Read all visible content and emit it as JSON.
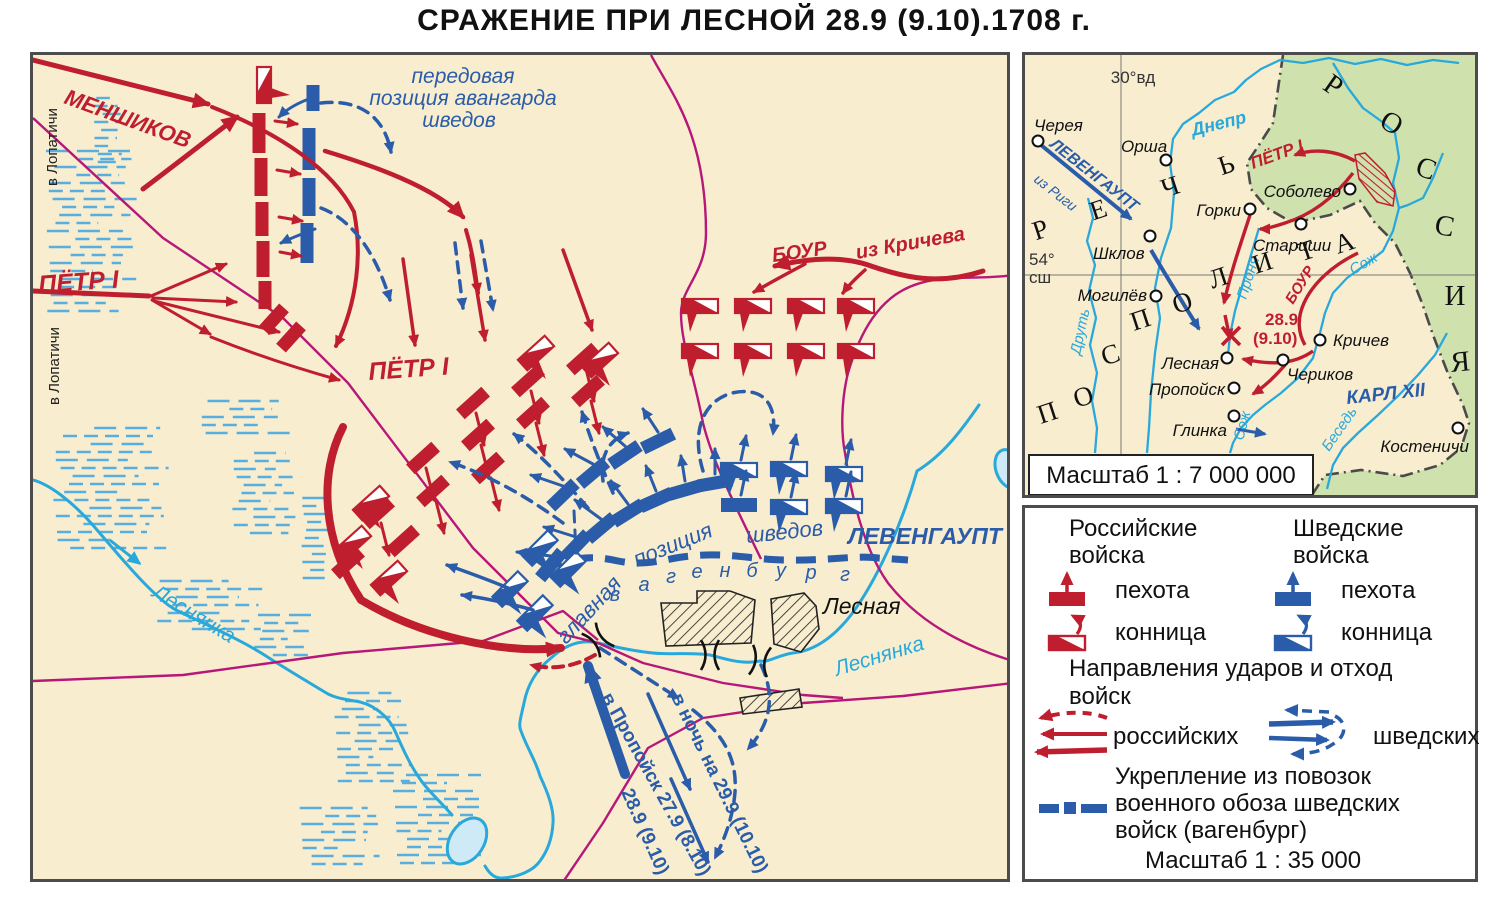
{
  "title": "СРАЖЕНИЕ  ПРИ  ЛЕСНОЙ  28.9 (9.10).1708 г.",
  "colors": {
    "paper": "#f8edcf",
    "red": "#bf1e2e",
    "blue": "#2a5caa",
    "cyan": "#29a8dc",
    "magenta": "#b61778",
    "green": "#cfe2ae",
    "black": "#151515",
    "lake": "#cdeaf6"
  },
  "main_map": {
    "labels": {
      "menshikov": "МЕНШИКОВ",
      "petr_left": "ПЁТР  I",
      "petr_center": "ПЁТР  I",
      "bour": "БОУР",
      "iz_kricheva": "из Кричева",
      "v_lopatichi_top": "в Лопатичи",
      "v_lopatichi_bottom": "в Лопатичи",
      "peredovaya_1": "передовая",
      "peredovaya_2": "позиция  авангарда",
      "peredovaya_3": "шведов",
      "glavnaya_1": "главная",
      "glavnaya_2": "позиция",
      "glavnaya_3": "шведов",
      "levengaupt": "ЛЕВЕНГАУПТ",
      "lesnaya_village": "Лесная",
      "lesnyanka_left": "Леснянка",
      "lesnyanka_right": "Леснянка",
      "wagenburg_letters": "вагенбург",
      "retreat_propoisk": "в Пропойск 27.9 (8.10)",
      "retreat_289": "28.9 (9.10)",
      "retreat_night": "в ночь на 29.9 (10.10)"
    }
  },
  "inset": {
    "meridian": "30°вд",
    "parallel_deg": "54°",
    "parallel_dir": "сш",
    "scale": "Масштаб 1 : 7 000 000",
    "region_rech": "РЕЧЬ",
    "region_pospolita": "ПОСПОЛИТА",
    "region_russia": "РОССИЯ",
    "labels": {
      "dnepr": "Днепр",
      "drut": "Друть",
      "pronya": "Проня",
      "sozh_1": "Сож",
      "sozh_2": "Сож",
      "besed": "Беседь",
      "levengaupt": "ЛЕВЕНГАУПТ",
      "iz_rigi": "из Риги",
      "petr": "ПЁТР I",
      "bour": "БОУР",
      "karl": "КАРЛ XII",
      "battle_date_1": "28.9",
      "battle_date_2": "(9.10)"
    },
    "cities": [
      {
        "name": "Черея",
        "x": 1035,
        "y": 138,
        "tx": 1031,
        "ty": 128,
        "anchor": "start"
      },
      {
        "name": "Орша",
        "x": 1163,
        "y": 157,
        "tx": 1118,
        "ty": 149,
        "anchor": "start"
      },
      {
        "name": "Соболево",
        "x": 1347,
        "y": 186,
        "tx": 1338,
        "ty": 194,
        "anchor": "end"
      },
      {
        "name": "Горки",
        "x": 1247,
        "y": 206,
        "tx": 1238,
        "ty": 213,
        "anchor": "end"
      },
      {
        "name": "Стариши",
        "x": 1298,
        "y": 221,
        "tx": 1250,
        "ty": 248,
        "anchor": "start"
      },
      {
        "name": "Шклов",
        "x": 1147,
        "y": 233,
        "tx": 1090,
        "ty": 256,
        "anchor": "start"
      },
      {
        "name": "Могилёв",
        "x": 1153,
        "y": 293,
        "tx": 1144,
        "ty": 298,
        "anchor": "end"
      },
      {
        "name": "Лесная",
        "x": 1224,
        "y": 355,
        "tx": 1216,
        "ty": 366,
        "anchor": "end"
      },
      {
        "name": "Пропойск",
        "x": 1231,
        "y": 385,
        "tx": 1222,
        "ty": 392,
        "anchor": "end"
      },
      {
        "name": "Глинка",
        "x": 1231,
        "y": 413,
        "tx": 1224,
        "ty": 433,
        "anchor": "end"
      },
      {
        "name": "Кричев",
        "x": 1317,
        "y": 337,
        "tx": 1330,
        "ty": 343,
        "anchor": "start"
      },
      {
        "name": "Чериков",
        "x": 1280,
        "y": 357,
        "tx": 1284,
        "ty": 377,
        "anchor": "start"
      },
      {
        "name": "Костеничи",
        "x": 1455,
        "y": 425,
        "tx": 1466,
        "ty": 449,
        "anchor": "end"
      }
    ]
  },
  "legend": {
    "rus_header": "Российские\nвойска",
    "swe_header": "Шведские\nвойска",
    "infantry_rus": "пехота",
    "cavalry_rus": "конница",
    "infantry_swe": "пехота",
    "cavalry_swe": "конница",
    "directions_1": "Направления ударов  и отход",
    "directions_2": "войск",
    "arrows_rus": "российских",
    "arrows_swe": "шведских",
    "wagenburg_1": "Укрепление из повозок",
    "wagenburg_2": "военного обоза шведских",
    "wagenburg_3": "войск (вагенбург)",
    "scale": "Масштаб 1 : 35 000"
  }
}
